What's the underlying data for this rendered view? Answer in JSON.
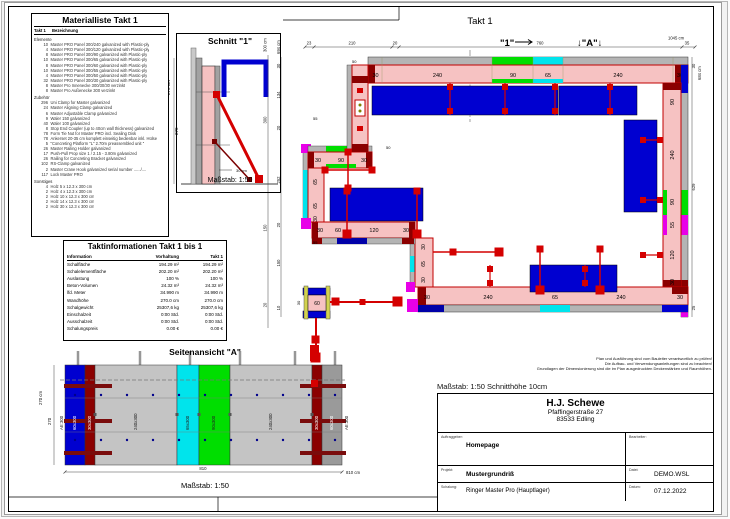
{
  "materialliste": {
    "title": "Materialliste  Takt 1",
    "col_takt": "Takt 1",
    "col_bezeichnung": "Bezeichnung",
    "groups": [
      {
        "name": "Elemente",
        "items": [
          {
            "qty": "10",
            "desc": "Master PRO Panel 300/240 galvanized with Plastic-ply"
          },
          {
            "qty": "4",
            "desc": "Master PRO Panel 300/120 galvanized with Plastic-ply"
          },
          {
            "qty": "8",
            "desc": "Master PRO Panel 300/90 galvanized with Plastic-ply"
          },
          {
            "qty": "10",
            "desc": "Master PRO Panel 300/65 galvanized with Plastic-ply"
          },
          {
            "qty": "8",
            "desc": "Master PRO Panel 300/60 galvanized with Plastic-ply"
          },
          {
            "qty": "10",
            "desc": "Master PRO Panel 300/55 galvanized with Plastic-ply"
          },
          {
            "qty": "4",
            "desc": "Master PRO Panel 300/50 galvanized with Plastic-ply"
          },
          {
            "qty": "32",
            "desc": "Master PRO Panel 300/30 galvanized with Plastic-ply"
          },
          {
            "qty": "8",
            "desc": "Master Pro Innenecke 300/30/30 verzinkt"
          },
          {
            "qty": "8",
            "desc": "Master Pro Außenecke 300 verzinkt"
          }
        ]
      },
      {
        "name": "Zubehör",
        "items": [
          {
            "qty": "296",
            "desc": "Uni Clamp for Master galvanized"
          },
          {
            "qty": "24",
            "desc": "Master Aligning Clamp galvanized"
          },
          {
            "qty": "6",
            "desc": "Master Adjustable Clamp galvanized"
          },
          {
            "qty": "9",
            "desc": "Waler 150 galvanized"
          },
          {
            "qty": "40",
            "desc": "Waler 100 galvanized"
          },
          {
            "qty": "8",
            "desc": "Stop End Coupler (up to 40cm wall thickness) galvanized"
          },
          {
            "qty": "78",
            "desc": "Form Tie Nut for Master PRO incl. Sealing Disk"
          },
          {
            "qty": "78",
            "desc": "Ankerset 20-35 cm komplett einseitig bedienbar inkl. Hülse"
          },
          {
            "qty": "5",
            "desc": "\"Concreting Platform \"L\" 2.70m preassembled unit \""
          },
          {
            "qty": "26",
            "desc": "Master Railing Holder galvanized"
          },
          {
            "qty": "17",
            "desc": "Push-Pull Prop size 1 / 2.15 - 3.80m galvanized"
          },
          {
            "qty": "26",
            "desc": "Railing for Concreting Bracket galvanized"
          },
          {
            "qty": "102",
            "desc": "RS-Clamp galvanized"
          },
          {
            "qty": "2",
            "desc": "Master Crane Hook galvanized serial number ....../...."
          },
          {
            "qty": "117",
            "desc": "Lock Master PRO"
          }
        ]
      },
      {
        "name": "Sonstiges",
        "items": [
          {
            "qty": "4",
            "desc": "Holz 5 x 12.3 x 300 cm"
          },
          {
            "qty": "2",
            "desc": "Holz 4 x 12.3 x 300 cm"
          },
          {
            "qty": "2",
            "desc": "Holz 10 x 12.3 x 300 cm"
          },
          {
            "qty": "2",
            "desc": "Holz 14 x 12.3 x 300 cm"
          },
          {
            "qty": "2",
            "desc": "Holz 30 x 12.3 x 300 cm"
          }
        ]
      }
    ]
  },
  "schnitt": {
    "title": "Schnitt \"1\"",
    "scale": "Maßstab: 1:50",
    "dim_small": "30 cm",
    "dim_total": "270 cm",
    "dim_seg": "270"
  },
  "taktinfo": {
    "title": "Taktinformationen  Takt 1 bis 1",
    "headers": [
      "Information",
      "Vorhaltung",
      "Takt 1"
    ],
    "rows": [
      [
        "Schalfläche",
        "194.29 m²",
        "194.29 m²"
      ],
      [
        "Schalelementfläche",
        "202.20 m²",
        "202.20 m²"
      ],
      [
        "Auslastung",
        "100 %",
        "100 %"
      ],
      [
        "Beton-Volumen",
        "24.32 m³",
        "24.32 m³"
      ],
      [
        "lfd. Meter",
        "34.990 m",
        "34.990 m"
      ],
      [
        "Wandhöhe",
        "270.0 cm",
        "270.0 cm"
      ],
      [
        "Schalgewicht",
        "25307,6 kg",
        "25307,6 kg"
      ],
      [
        "Einschalzeit",
        "0:00 Std.",
        "0:00 Std."
      ],
      [
        "Ausschalzeit",
        "0:00 Std.",
        "0:00 Std."
      ],
      [
        "Schalungspreis",
        "0.00 €",
        "0.00 €"
      ]
    ]
  },
  "plan": {
    "title": "Takt 1",
    "cut_label": "\"1\"",
    "view_label": "↓\"A\"↓",
    "walls": {
      "top": [
        "30",
        "240",
        "90",
        "65",
        "240",
        "30"
      ],
      "right": [
        "90",
        "240",
        "90",
        "55",
        "120",
        "30"
      ],
      "bottom": [
        "30",
        "240",
        "65",
        "240",
        "30"
      ],
      "step": [
        "30",
        "60",
        "120",
        "30"
      ],
      "connector": [
        "30",
        "65",
        "30"
      ],
      "wing_left": [
        "30",
        "65",
        "65",
        "30"
      ],
      "wing_top": [
        "30",
        "90",
        "30"
      ],
      "tl_connector_label": "14",
      "misc": [
        "50",
        "50",
        "55",
        "55"
      ]
    },
    "column": {
      "width_label": "60",
      "side_label": "30"
    },
    "dims": {
      "top_segs": [
        "23",
        "210",
        "20",
        "760",
        "35"
      ],
      "top_total": "1045 cm",
      "left_outer_total": "300 cm",
      "left_outer_segs": [
        "300",
        "150",
        "20"
      ],
      "left_inner_total": "694 cm",
      "left_inner_segs": [
        "30",
        "134",
        "20",
        "252",
        "20",
        "150",
        "10"
      ],
      "right_total": "684 cm",
      "right_segs": [
        "30",
        "629",
        "25"
      ]
    }
  },
  "side_view": {
    "title": "Seitenansicht \"A\"",
    "panel_labels": [
      "AE:300",
      "60x300",
      "30x300",
      "240x300",
      "65x300",
      "90x300",
      "240x300",
      "30x300",
      "60x300",
      "AE:300"
    ],
    "dim_bottom": "810",
    "dim_bottom_total": "810 cm",
    "dim_left_total": "270 cm",
    "dim_left_seg": "270",
    "scale": "Maßstab: 1:50"
  },
  "footer": {
    "notes": [
      "Plan und Ausführung sind vom Bauleiter verantwortlich zu prüfen!",
      "Die Aufbau- und Verwendungsanleitungen sind zu beachten!",
      "Grundlagen der Dimensionierung sind die im Plan ausgedruckten Deckenstärken und Raumhöhen."
    ],
    "scale_line": "Maßstab: 1:50   Schnitthöhe 10cm"
  },
  "title_block": {
    "company": "H.J. Schewe",
    "address1": "Pfaffingerstraße 27",
    "address2": "83533 Edling",
    "label_auftraggeber": "Auftraggeber:",
    "auftraggeber": "Homepage",
    "label_bearbeiter": "Bearbeiter:",
    "bearbeiter": "",
    "label_projekt": "Projekt:",
    "projekt": "Mustergrundriß",
    "label_datei": "Datei:",
    "datei": "DEMO.WSL",
    "label_schalung": "Schalung:",
    "schalung": "Ringer Master Pro (Hauptlager)",
    "label_datum": "Datum:",
    "datum": "07.12.2022"
  },
  "colors": {
    "wall_core_pink": "#f6c2c2",
    "panel_gray": "#b4b4b4",
    "dark_red": "#8b0000",
    "red": "#d40000",
    "blue": "#0000d0",
    "green": "#00de00",
    "cyan": "#00e4ec",
    "magenta": "#e800e8",
    "yellow": "#d2d24e"
  }
}
